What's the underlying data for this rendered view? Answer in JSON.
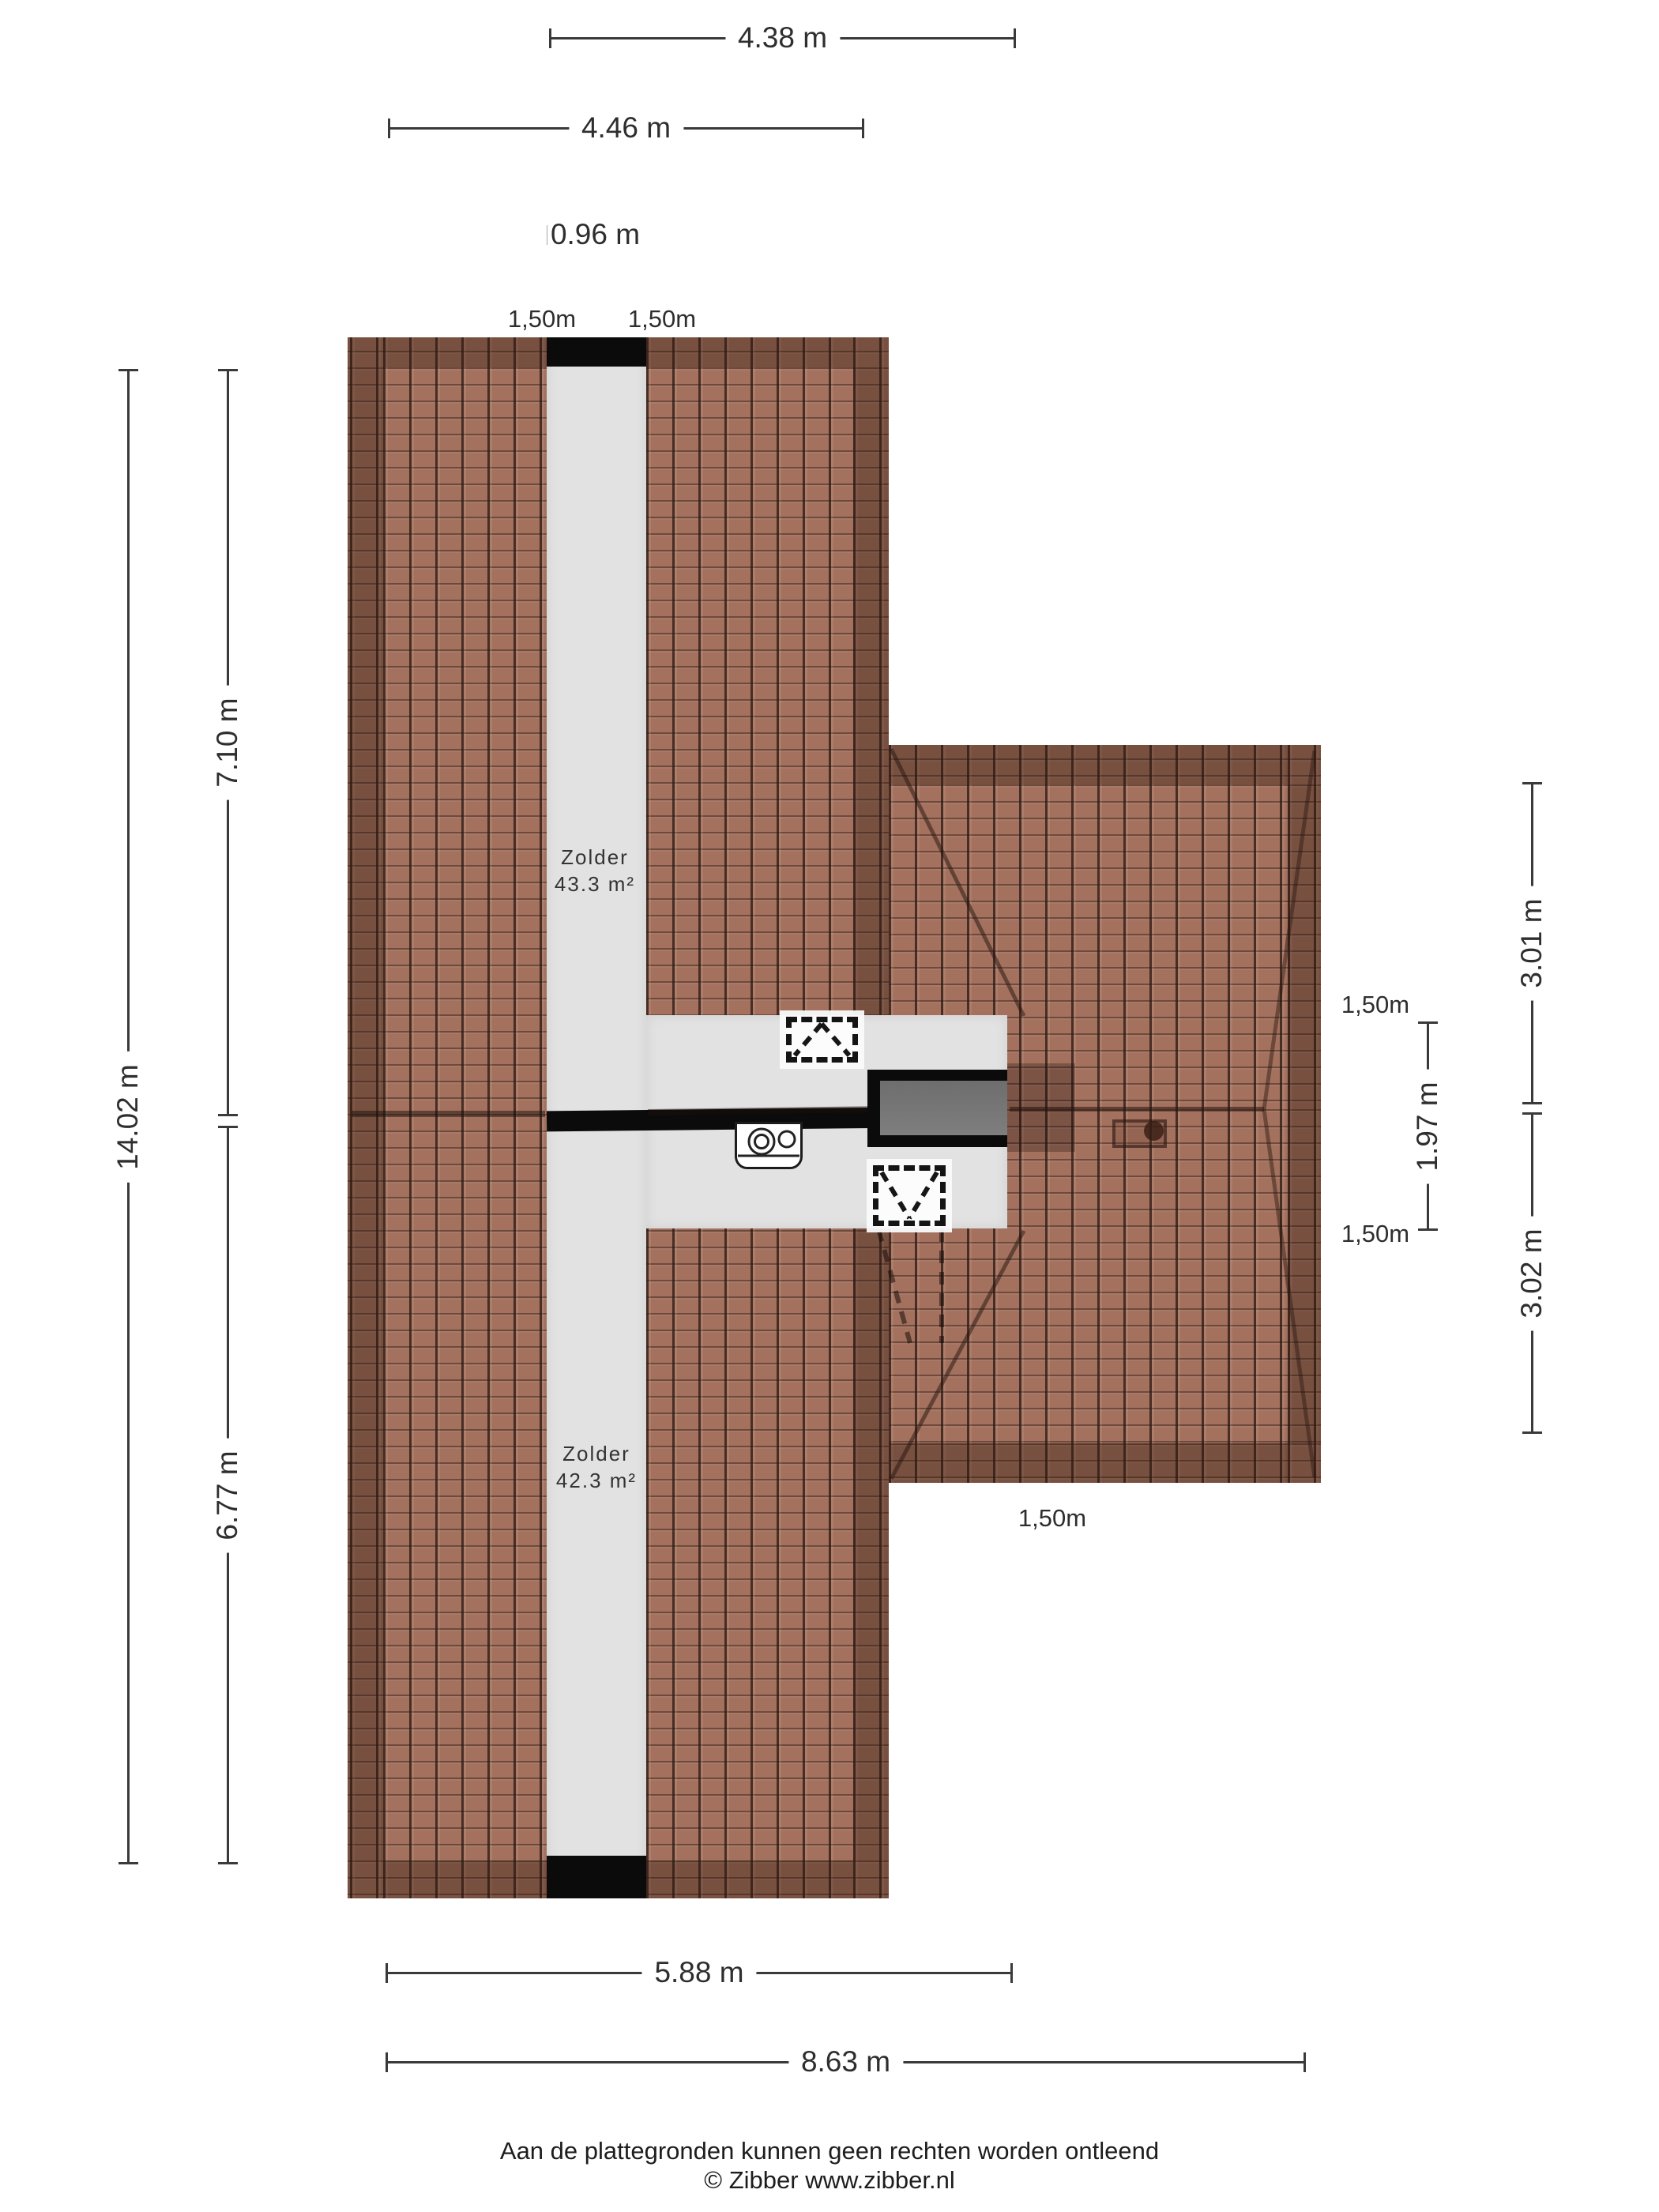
{
  "dims": {
    "d438": "4.38 m",
    "d446": "4.46 m",
    "d096": "0.96 m",
    "d1402": "14.02 m",
    "d710": "7.10 m",
    "d677": "6.77 m",
    "d301": "3.01 m",
    "d197": "1.97 m",
    "d302": "3.02 m",
    "d588": "5.88 m",
    "d863": "8.63 m"
  },
  "headroom": {
    "top_left": "1,50m",
    "top_right": "1,50m",
    "right_upper": "1,50m",
    "right_lower": "1,50m",
    "bottom": "1,50m"
  },
  "rooms": {
    "upper": {
      "name": "Zolder",
      "area": "43.3 m²"
    },
    "lower": {
      "name": "Zolder",
      "area": "42.3 m²"
    }
  },
  "footer": {
    "disclaimer": "Aan de plattegronden kunnen geen rechten worden ontleend",
    "copyright": "© Zibber www.zibber.nl"
  },
  "colors": {
    "roof_tile": "#a3715e",
    "roof_joint": "#2e1a13",
    "floor": "#e2e2e2",
    "wall": "#0b0b0b",
    "stair_fill": "#747474",
    "dimension_text": "#2e2e2e",
    "dimension_line": "#3a3a3a"
  }
}
